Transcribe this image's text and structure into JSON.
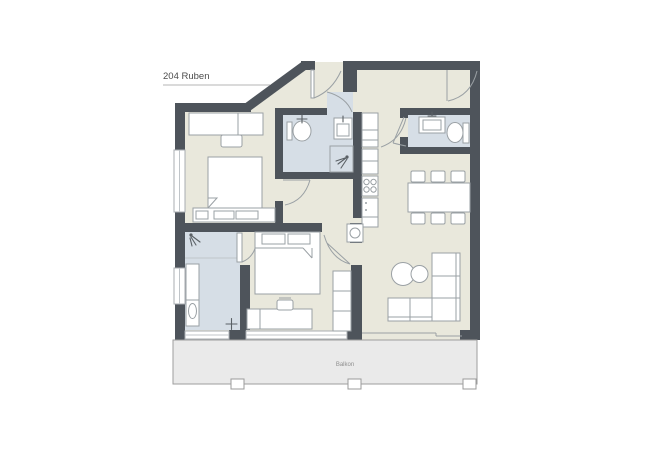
{
  "plan": {
    "unit_label": "204 Ruben",
    "balcony_label": "Balkon",
    "colors": {
      "wall": "#4e545b",
      "floor": "#e9e8dc",
      "tile": "#d6dee6",
      "balcony": "#eaeaea",
      "balcony_border": "#9e9e9e",
      "furniture_stroke": "#9aa0a4",
      "furniture_fill": "#ffffff",
      "door_line": "#9aa0a4",
      "fixture_accent": "#5a6065",
      "title_text": "#4d4d4d",
      "balcony_text": "#8f8f8f",
      "rule_line": "#b4b4b4"
    }
  }
}
